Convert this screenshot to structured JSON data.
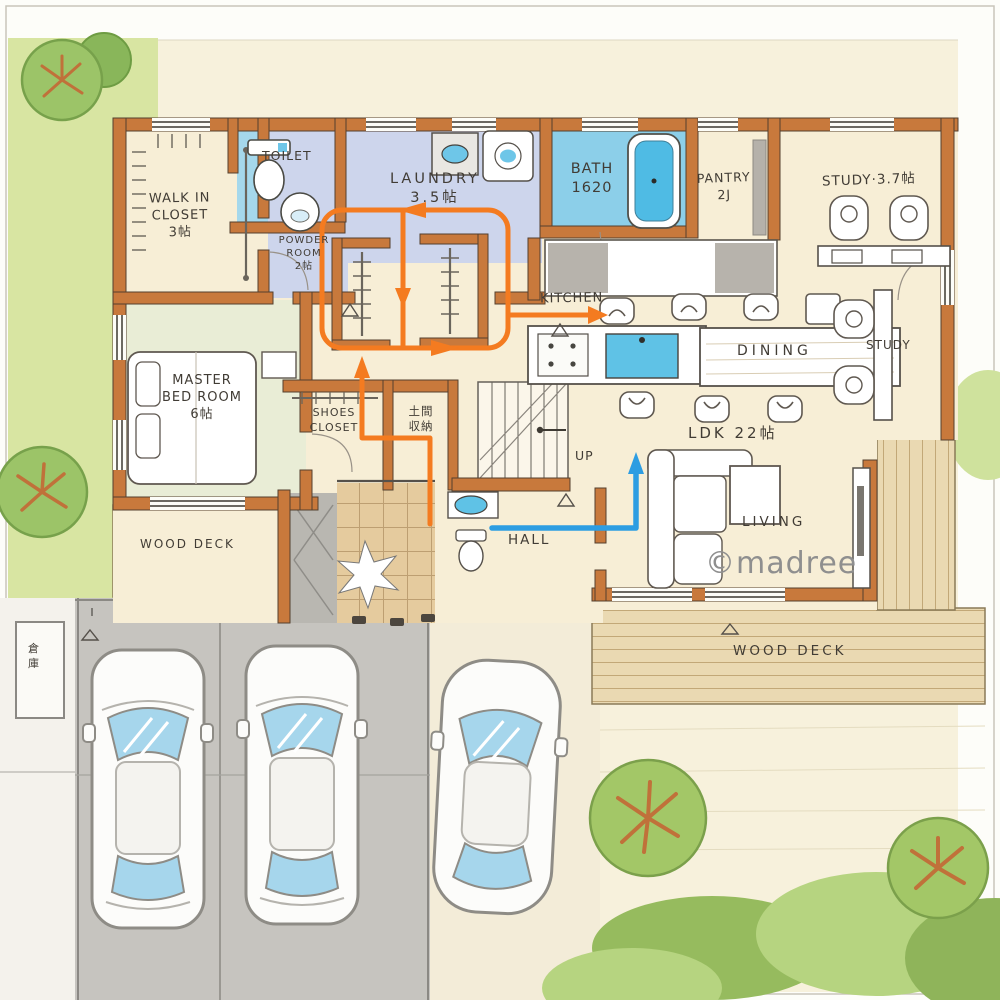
{
  "plan_title": "hand-drawn house floor plan (1F)",
  "watermark": "©madree",
  "labels": {
    "wic": "WALK IN\nCLOSET\n3帖",
    "toilet": "TOILET",
    "powder": "POWDER\nROOM\n2帖",
    "laundry": "LAUNDRY\n3.5帖",
    "bath": "BATH\n1620",
    "pantry": "PANTRY\n2J",
    "study_top": "STUDY·3.7帖",
    "kitchen": "KITCHEN",
    "dining": "DINING",
    "study_right": "STUDY",
    "ldk": "LDK 22帖",
    "master": "MASTER\nBED ROOM\n6帖",
    "shoes": "SHOES\nCLOSET",
    "doma": "土間\n収納",
    "up": "UP",
    "hall": "HALL",
    "living": "LIVING",
    "deck_left": "WOOD DECK",
    "deck_bottom": "WOOD DECK",
    "souko": "倉庫"
  },
  "flows": [
    {
      "name": "laundry-family-closet-loop",
      "color": "#f47b20"
    },
    {
      "name": "entry-to-living",
      "color": "#2d9de2"
    }
  ],
  "colors": {
    "wall": "#c8793c",
    "wet_floor": "#cdd5ec",
    "toilet_floor": "#a5d8ec",
    "bath_water": "#4fbbe4",
    "master_floor": "#e9edd6",
    "cream_floor": "#f7eed6",
    "deck": "#ead9b2",
    "lawn": "#d8e5a2",
    "driveway": "#c6c4bf",
    "flow_orange": "#f47b20",
    "flow_blue": "#2d9de2"
  }
}
